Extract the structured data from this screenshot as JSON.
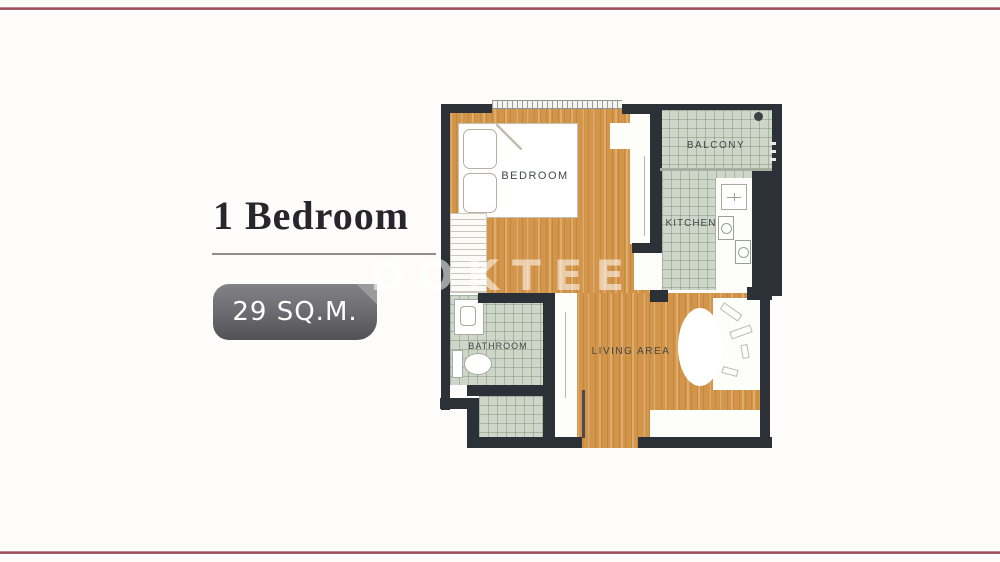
{
  "listing": {
    "title": "1 Bedroom",
    "area_badge": "29 SQ.M."
  },
  "watermark": "DOKTEE",
  "colors": {
    "accent_rule": "#8e4250",
    "badge_gradient_top": "#838387",
    "badge_gradient_bottom": "#515156",
    "wall": "#2b3136",
    "wood_floor": "#d2954a",
    "tile_floor": "#cdd6c8",
    "title_text": "#26262c"
  },
  "floorplan": {
    "rooms": [
      {
        "id": "bedroom",
        "label": "BEDROOM"
      },
      {
        "id": "balcony",
        "label": "BALCONY"
      },
      {
        "id": "kitchen",
        "label": "KITCHEN"
      },
      {
        "id": "bathroom",
        "label": "BATHROOM"
      },
      {
        "id": "living",
        "label": "LIVING AREA"
      }
    ]
  }
}
